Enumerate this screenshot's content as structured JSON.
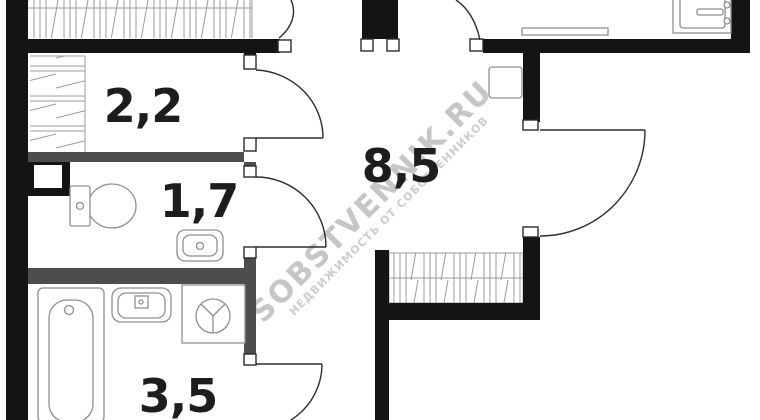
{
  "plan": {
    "type": "apartment-floor-plan",
    "rooms": [
      {
        "id": "storage",
        "area": "2,2"
      },
      {
        "id": "wc",
        "area": "1,7"
      },
      {
        "id": "hallway",
        "area": "8,5"
      },
      {
        "id": "bathroom",
        "area": "3,5"
      }
    ],
    "watermark": {
      "line1": "SOBSTVENNIK.RU",
      "line2": "НЕДВИЖИМОСТЬ ОТ СОБСТВЕННИКОВ"
    },
    "symbols": [
      "toilet-symbol",
      "sink-symbol",
      "bathtub-symbol",
      "washing-machine-symbol",
      "stove-symbol",
      "kitchen-counter-symbol",
      "wardrobe-hatch-symbol",
      "door-arc-symbol",
      "vent-shaft-symbol",
      "cabinet-symbol"
    ],
    "colors": {
      "wall": "#141414",
      "partition": "#4d4d4d",
      "fixture_outline": "#8f8f8f",
      "hatch": "#9b9b9b",
      "label": "#1d1d1d",
      "watermark": "#c6c6c6"
    }
  }
}
